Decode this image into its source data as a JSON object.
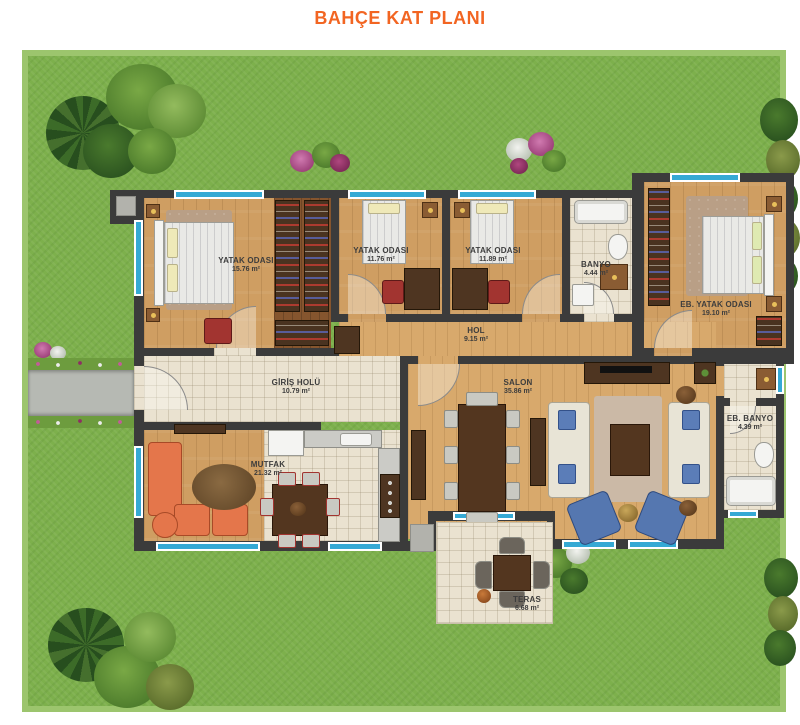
{
  "title": "BAHÇE KAT PLANI",
  "colors": {
    "title": "#f26522",
    "grass": "#7db04c",
    "wall": "#3b3b3b",
    "wood_floor": "#cf9e62",
    "tile_floor": "#eae2d0",
    "window_glass": "#35a9d4",
    "sofa_orange": "#e4764b",
    "armchair_blue": "#5577b0"
  },
  "rooms": [
    {
      "id": "yatak-odasi-1",
      "name": "YATAK ODASI",
      "area": "15.76 m²"
    },
    {
      "id": "yatak-odasi-2",
      "name": "YATAK ODASI",
      "area": "11.76 m²"
    },
    {
      "id": "yatak-odasi-3",
      "name": "YATAK ODASI",
      "area": "11.89 m²"
    },
    {
      "id": "banyo",
      "name": "BANYO",
      "area": "4.44 m²"
    },
    {
      "id": "eb-yatak-odasi",
      "name": "EB. YATAK ODASI",
      "area": "19.10 m²"
    },
    {
      "id": "hol",
      "name": "HOL",
      "area": "9.15 m²"
    },
    {
      "id": "giris-holu",
      "name": "GİRİŞ HOLÜ",
      "area": "10.79 m²"
    },
    {
      "id": "salon",
      "name": "SALON",
      "area": "35.86 m²"
    },
    {
      "id": "mutfak",
      "name": "MUTFAK",
      "area": "21.32 m²"
    },
    {
      "id": "eb-banyo",
      "name": "EB. BANYO",
      "area": "4.39 m²"
    },
    {
      "id": "teras",
      "name": "TERAS",
      "area": "6.68 m²"
    }
  ]
}
